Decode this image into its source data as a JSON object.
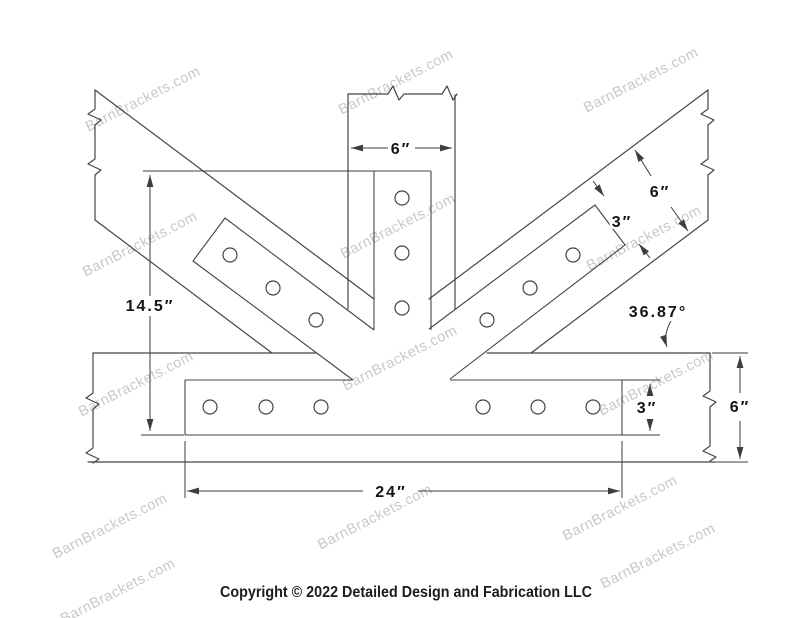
{
  "watermark": {
    "text": "BarnBrackets.com"
  },
  "footer": {
    "copyright": "Copyright © 2022 Detailed Design and Fabrication LLC"
  },
  "dimensions": {
    "vertical_member_width": "6″",
    "right_diagonal_width": "6″",
    "right_diagonal_plate_width": "3″",
    "left_height": "14.5″",
    "angle": "36.87°",
    "bottom_plate_height": "3″",
    "bottom_member_height": "6″",
    "bottom_plate_length": "24″"
  }
}
